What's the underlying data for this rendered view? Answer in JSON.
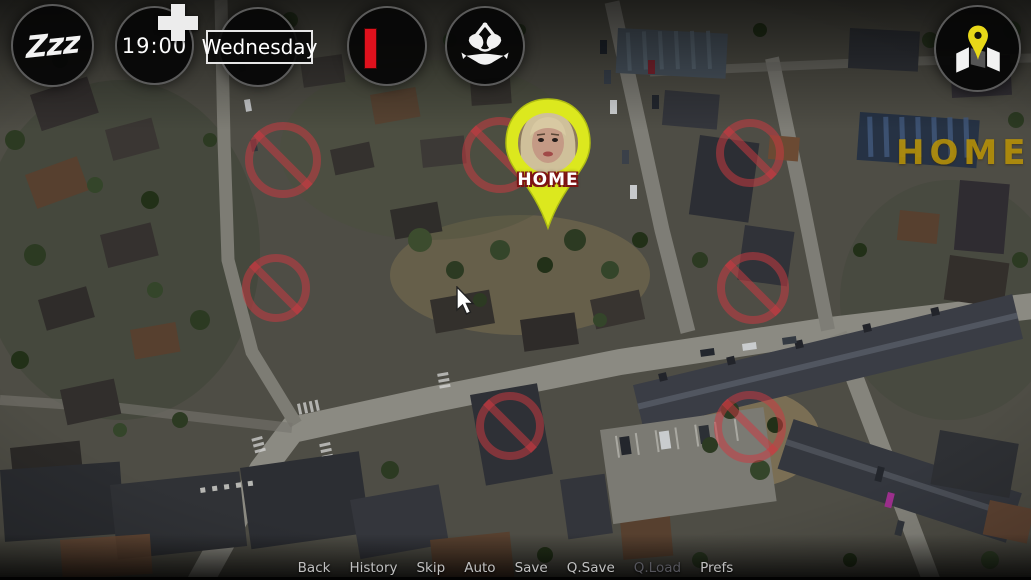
{
  "hud": {
    "sleep_button": {
      "label": "Zzz"
    },
    "time_display": {
      "value": "19:00"
    },
    "add_time_button": {
      "icon": "plus-icon"
    },
    "day_display": {
      "value": "Wednesday"
    },
    "status_button": {
      "icon": "red-bar-icon"
    },
    "wardrobe_button": {
      "icon": "bikini-icon"
    },
    "map_button": {
      "icon": "map-with-pin-icon"
    }
  },
  "map": {
    "home_marker": {
      "label": "HOME",
      "portrait_icon": "woman-portrait-photo",
      "pin_color": "#dce81e"
    },
    "watermark_label": "HOME",
    "blocked_locations": [
      {
        "x": 283,
        "y": 160,
        "r": 38
      },
      {
        "x": 500,
        "y": 155,
        "r": 38
      },
      {
        "x": 750,
        "y": 153,
        "r": 34
      },
      {
        "x": 276,
        "y": 288,
        "r": 34
      },
      {
        "x": 753,
        "y": 288,
        "r": 36
      },
      {
        "x": 510,
        "y": 426,
        "r": 34
      },
      {
        "x": 750,
        "y": 427,
        "r": 36
      }
    ]
  },
  "quick_menu": {
    "items": [
      {
        "label": "Back",
        "enabled": true
      },
      {
        "label": "History",
        "enabled": true
      },
      {
        "label": "Skip",
        "enabled": true
      },
      {
        "label": "Auto",
        "enabled": true
      },
      {
        "label": "Save",
        "enabled": true
      },
      {
        "label": "Q.Save",
        "enabled": true
      },
      {
        "label": "Q.Load",
        "enabled": false
      },
      {
        "label": "Prefs",
        "enabled": true
      }
    ]
  },
  "cursor": {
    "x": 455,
    "y": 286
  },
  "colors": {
    "pin_yellow": "#dce81e",
    "blocked_red": "#ce3a42",
    "status_red": "#e0111d",
    "watermark_yellow": "#c49c08"
  }
}
